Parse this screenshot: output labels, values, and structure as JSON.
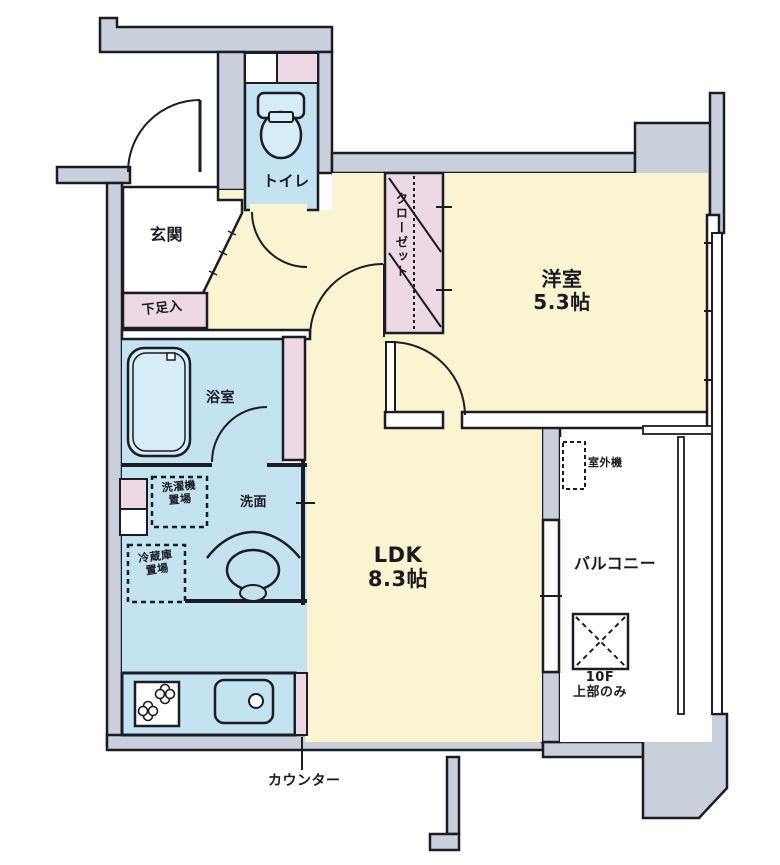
{
  "floorplan": {
    "kind": "apartment-floorplan",
    "rooms": {
      "entrance": {
        "label": "玄関"
      },
      "shoe_cabinet": {
        "label": "下足入"
      },
      "toilet": {
        "label": "トイレ"
      },
      "closet": {
        "label": "クローゼット"
      },
      "bedroom": {
        "name": "洋室",
        "size": "5.3帖"
      },
      "bathroom": {
        "label": "浴室"
      },
      "washroom": {
        "label": "洗面"
      },
      "washer_space": {
        "line1": "洗濯機",
        "line2": "置場"
      },
      "fridge_space": {
        "line1": "冷蔵庫",
        "line2": "置場"
      },
      "ldk": {
        "name": "LDK",
        "size": "8.3帖"
      },
      "counter": {
        "label": "カウンター"
      },
      "balcony": {
        "label": "バルコニー"
      },
      "outdoor_unit": {
        "label": "室外機"
      },
      "hatch_note": {
        "line1": "10F",
        "line2": "上部のみ"
      }
    },
    "colors": {
      "room_yellow": "#faf4d0",
      "wet_blue": "#c3e3f0",
      "fixture_blue": "#d6edf7",
      "pink": "#ecd9e4",
      "wall_gray": "#c9cfdb",
      "line": "#1c1c24",
      "white": "#ffffff"
    }
  }
}
